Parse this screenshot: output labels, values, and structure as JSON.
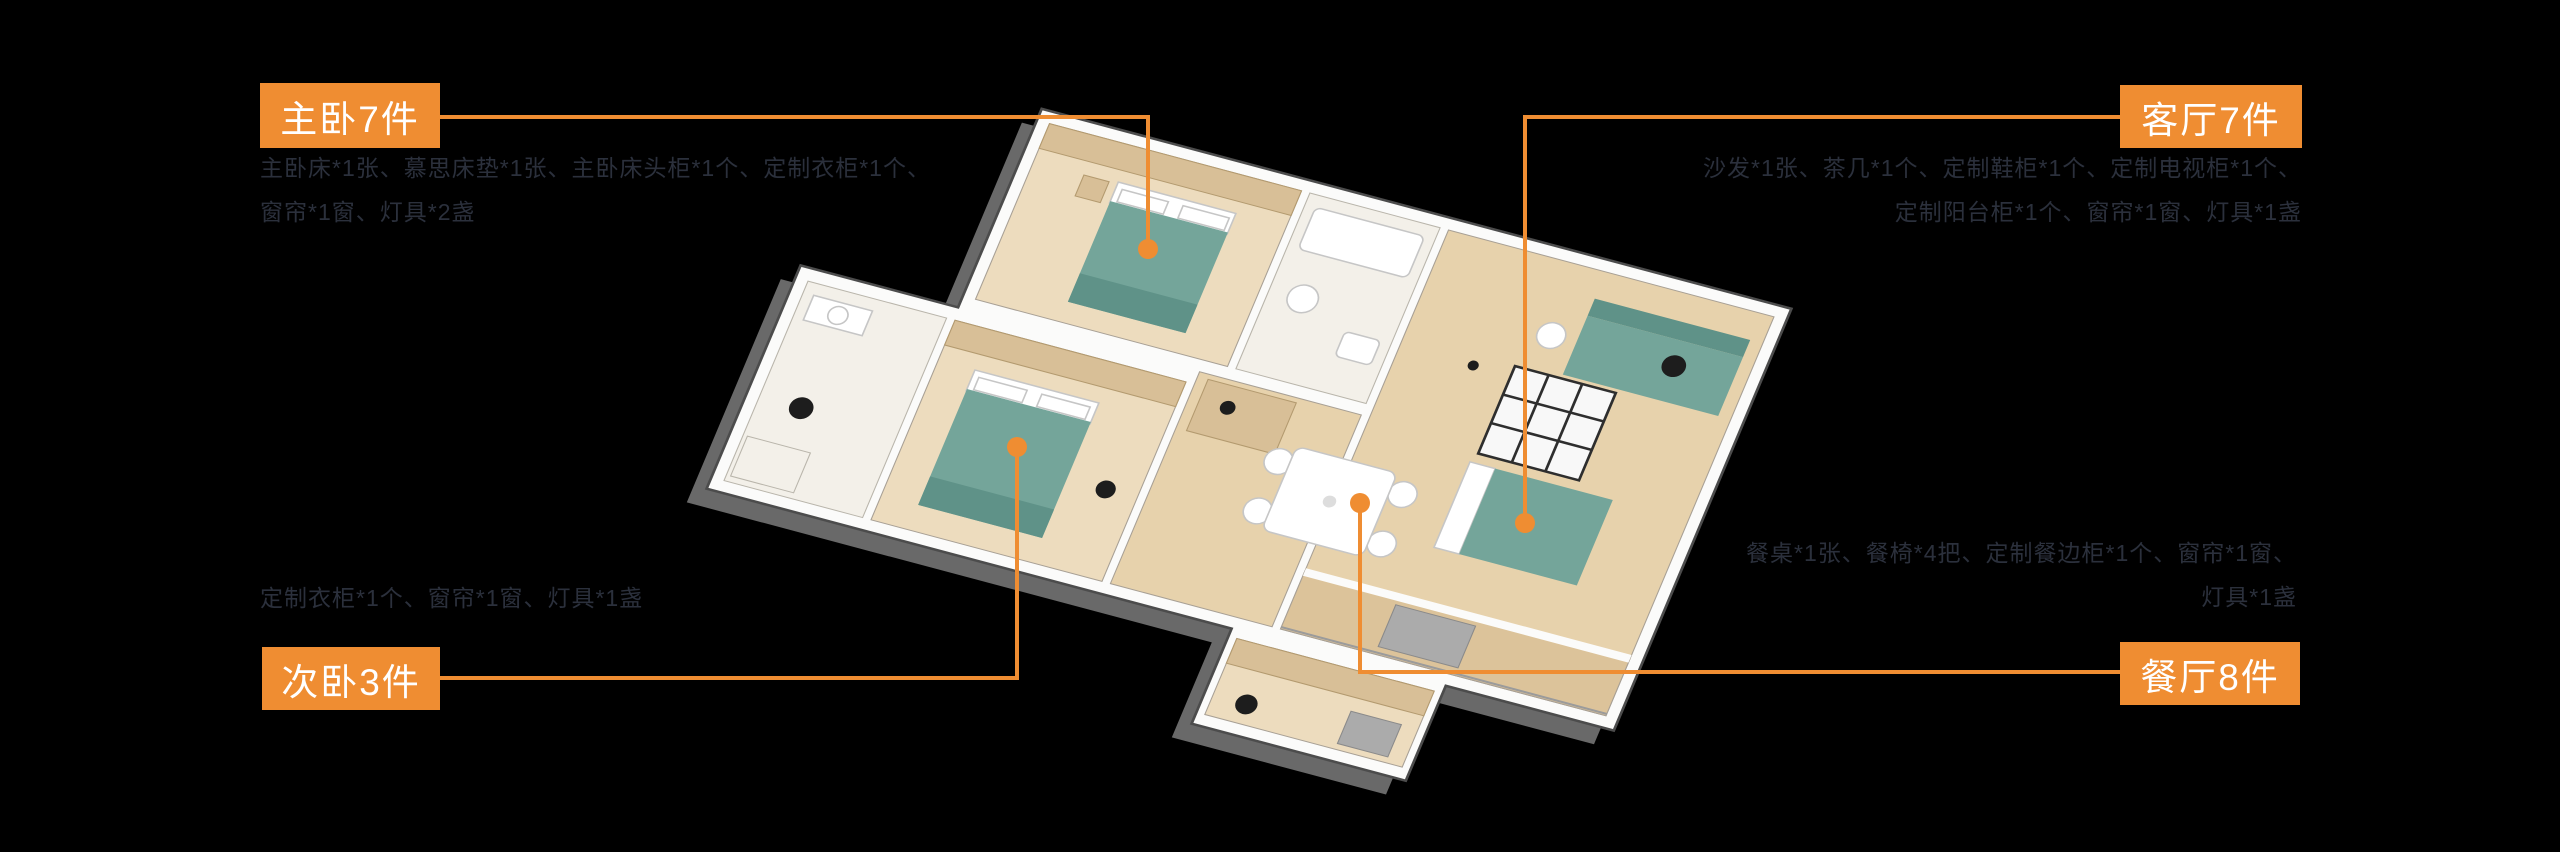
{
  "colors": {
    "accent": "#EF8D32",
    "description_text": "#2B303C",
    "background": "#000000",
    "furniture_teal": "#74A59A",
    "floor_wood": "#E7D2AC"
  },
  "labels": {
    "master_bedroom": {
      "title": "主卧7件",
      "items": [
        "主卧床*1张、慕思床垫*1张、主卧床头柜*1个、定制衣柜*1个、",
        "窗帘*1窗、灯具*2盏"
      ]
    },
    "living_room": {
      "title": "客厅7件",
      "items": [
        "沙发*1张、茶几*1个、定制鞋柜*1个、定制电视柜*1个、",
        "定制阳台柜*1个、窗帘*1窗、灯具*1盏"
      ]
    },
    "second_bedroom": {
      "title": "次卧3件",
      "items": [
        "定制衣柜*1个、窗帘*1窗、灯具*1盏"
      ]
    },
    "dining_room": {
      "title": "餐厅8件",
      "items": [
        "餐桌*1张、餐椅*4把、定制餐边柜*1个、窗帘*1窗、",
        "灯具*1盏"
      ]
    }
  }
}
